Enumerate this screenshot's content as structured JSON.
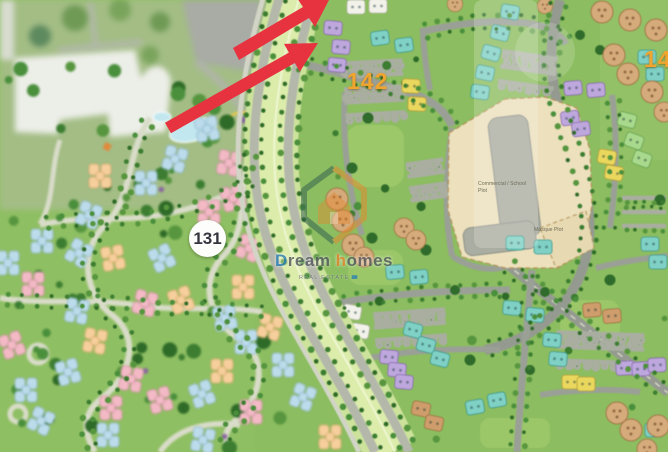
{
  "map": {
    "zones": {
      "left_zone_number": "131",
      "right_zone_number": "142",
      "edge_zone_number": "14"
    },
    "plots": {
      "commercial_line1": "Commercial / School",
      "commercial_line2": "Plot",
      "mosque": "Mosque Plot"
    }
  },
  "watermark": {
    "brand_d": "D",
    "brand_ream": "ream",
    "brand_h": "h",
    "brand_omes": "omes",
    "tagline": "REAL ESTATE"
  },
  "colors": {
    "arrow_red": "#e73240",
    "zone_label_orange": "#f0a52f",
    "watermark_orange": "#e8862d",
    "watermark_blue": "#2a7fb5"
  }
}
